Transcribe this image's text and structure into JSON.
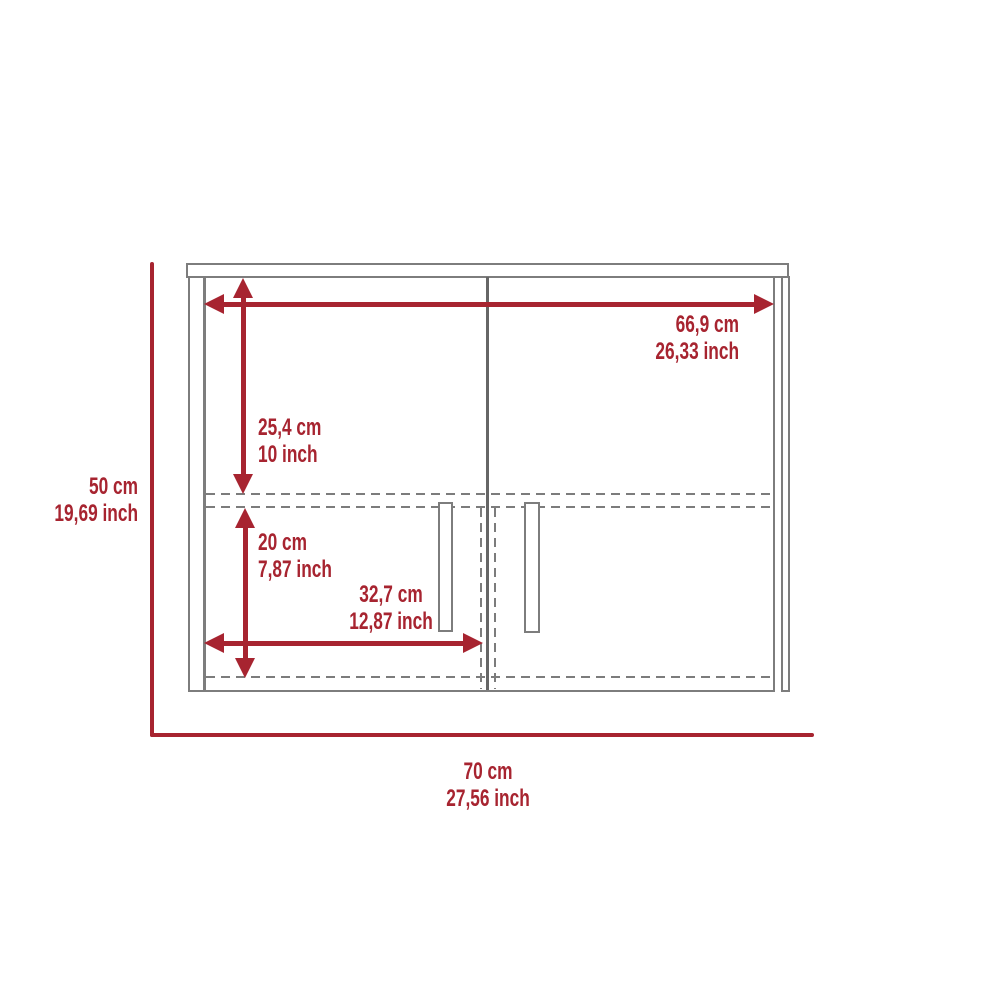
{
  "diagram": {
    "kind": "furniture-dimension-diagram",
    "subject": "two-door wall cabinet, front view",
    "colors": {
      "dimension_red": "#a72430",
      "outline_gray": "#7d7d7d",
      "door_divider_gray": "#666666"
    },
    "labels": {
      "overall_height": {
        "cm": "50 cm",
        "inch": "19,69 inch"
      },
      "overall_width": {
        "cm": "70 cm",
        "inch": "27,56 inch"
      },
      "top_width": {
        "cm": "66,9 cm",
        "inch": "26,33 inch"
      },
      "upper_height": {
        "cm": "25,4 cm",
        "inch": "10 inch"
      },
      "lower_height": {
        "cm": "20 cm",
        "inch": "7,87 inch"
      },
      "door_width": {
        "cm": "32,7 cm",
        "inch": "12,87 inch"
      }
    }
  }
}
